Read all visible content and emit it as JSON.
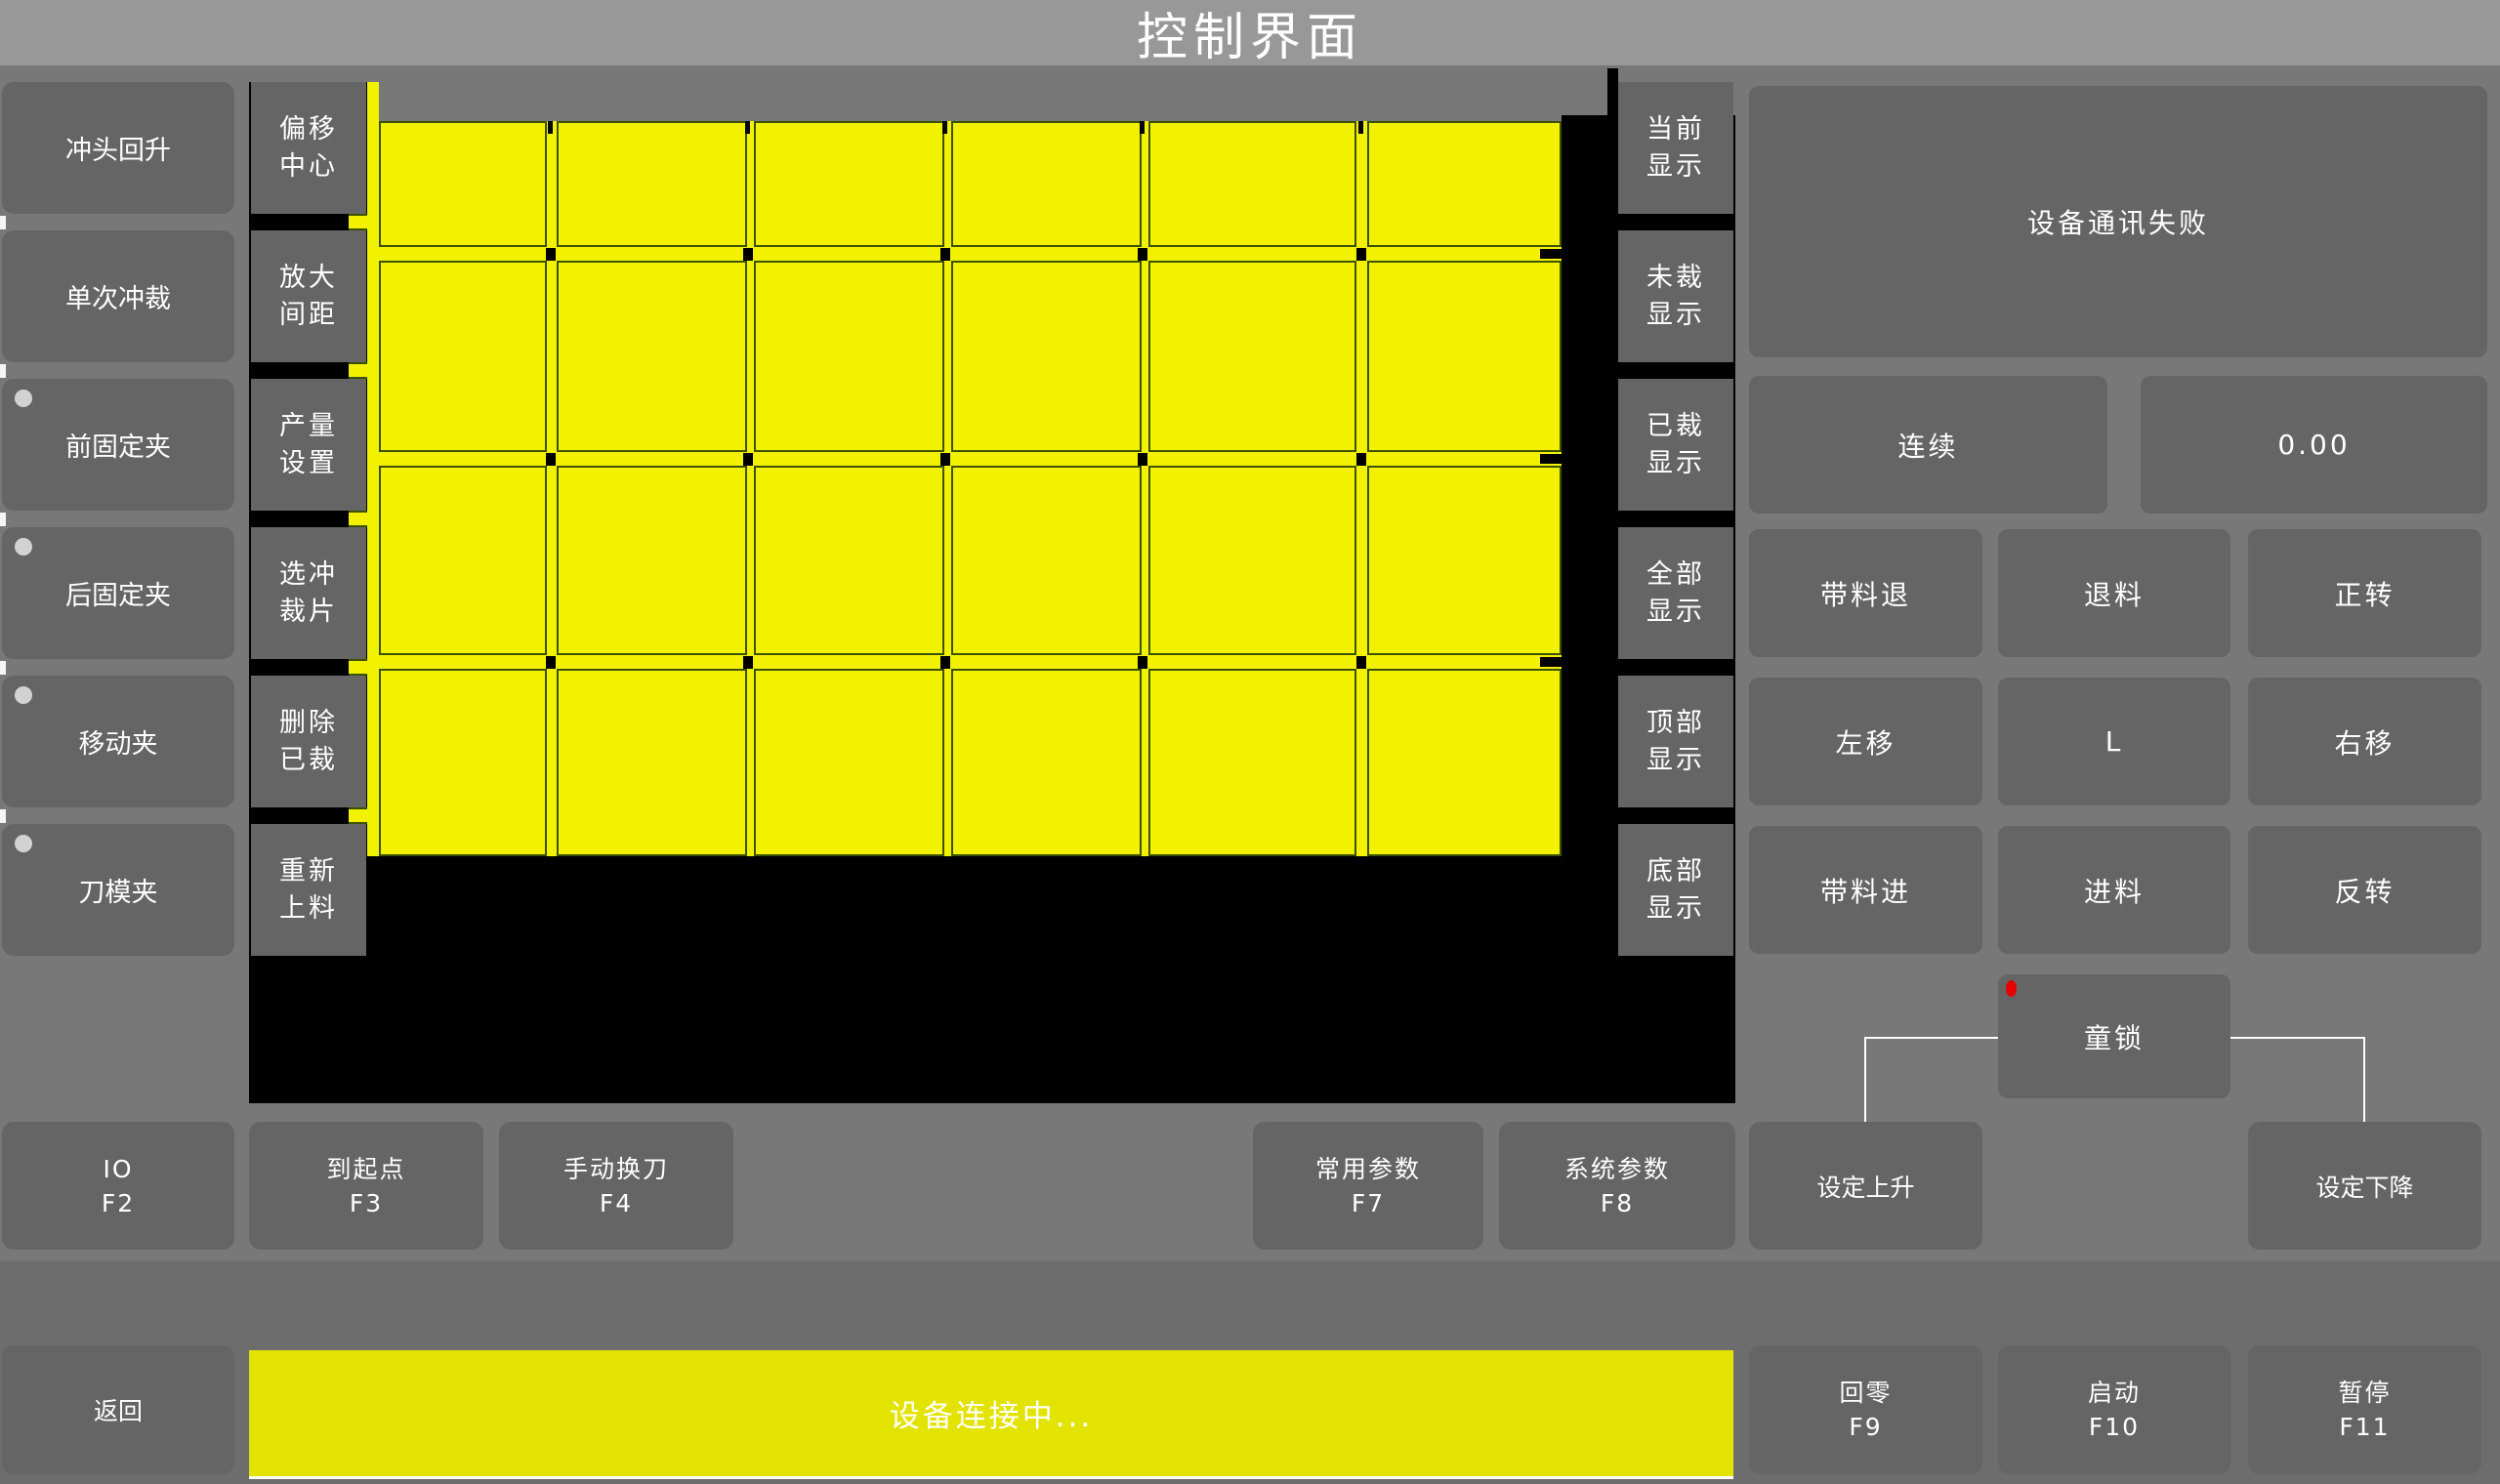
{
  "title": "控制界面",
  "left_buttons": [
    {
      "label": "冲头回升",
      "indicator": false
    },
    {
      "label": "单次冲裁",
      "indicator": false
    },
    {
      "label": "前固定夹",
      "indicator": true
    },
    {
      "label": "后固定夹",
      "indicator": true
    },
    {
      "label": "移动夹",
      "indicator": true
    },
    {
      "label": "刀模夹",
      "indicator": true
    }
  ],
  "tool_buttons": [
    {
      "line1": "偏移",
      "line2": "中心"
    },
    {
      "line1": "放大",
      "line2": "间距"
    },
    {
      "line1": "产量",
      "line2": "设置"
    },
    {
      "line1": "选冲",
      "line2": "裁片"
    },
    {
      "line1": "删除",
      "line2": "已裁"
    },
    {
      "line1": "重新",
      "line2": "上料"
    }
  ],
  "display_buttons": [
    {
      "line1": "当前",
      "line2": "显示"
    },
    {
      "line1": "未裁",
      "line2": "显示"
    },
    {
      "line1": "已裁",
      "line2": "显示"
    },
    {
      "line1": "全部",
      "line2": "显示"
    },
    {
      "line1": "顶部",
      "line2": "显示"
    },
    {
      "line1": "底部",
      "line2": "显示"
    }
  ],
  "status_panel": {
    "message": "设备通讯失败"
  },
  "control_panel": {
    "mode_button": "连续",
    "value_display": "0.00",
    "grid_buttons": [
      [
        "带料退",
        "退料",
        "正转"
      ],
      [
        "左移",
        "L",
        "右移"
      ],
      [
        "带料进",
        "进料",
        "反转"
      ]
    ],
    "child_lock": "童锁"
  },
  "function_row": [
    {
      "label": "IO",
      "key": "F2"
    },
    {
      "label": "到起点",
      "key": "F3"
    },
    {
      "label": "手动换刀",
      "key": "F4"
    },
    {
      "label": "常用参数",
      "key": "F7"
    },
    {
      "label": "系统参数",
      "key": "F8"
    }
  ],
  "set_buttons": {
    "rise": "设定上升",
    "fall": "设定下降"
  },
  "bottom_bar": {
    "back": "返回",
    "status": "设备连接中...",
    "buttons": [
      {
        "label": "回零",
        "key": "F9"
      },
      {
        "label": "启动",
        "key": "F10"
      },
      {
        "label": "暂停",
        "key": "F11"
      }
    ]
  },
  "colors": {
    "grid_yellow": "#f2f200",
    "status_yellow": "#e3e300",
    "alert_red": "#e60000",
    "panel_gray": "#656565",
    "background_gray": "#787878"
  }
}
